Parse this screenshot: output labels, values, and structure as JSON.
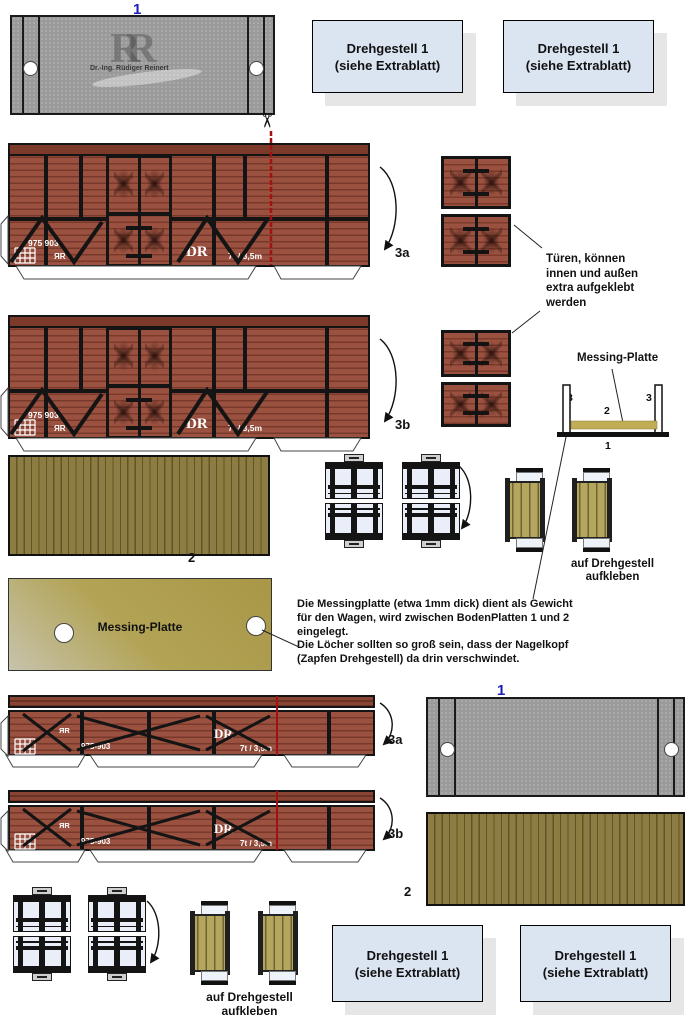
{
  "sheet": {
    "part1_label": "1",
    "part2_label": "2",
    "part3a_label": "3a",
    "part3b_label": "3b",
    "scissors_icon": "✂"
  },
  "drehgestell_box": {
    "line1": "Drehgestell 1",
    "line2": "(siehe Extrablatt)"
  },
  "watermark": {
    "initials": "RR",
    "name": "Dr.-Ing. Rüdiger Reinert"
  },
  "wagon_markings": {
    "number": "975 903",
    "number_dash": "975-903",
    "owner_small": "ЯR",
    "owner_large": "DR",
    "load_spec": "7t / 3,5m"
  },
  "notes": {
    "tueren": "Türen, können\ninnen und außen\nextra aufgeklebt\nwerden",
    "auf_drehgestell": "auf Drehgestell\naufkleben",
    "messing_instruction": "Die Messingplatte (etwa 1mm dick) dient als Gewicht\nfür den Wagen, wird zwischen BodenPlatten 1 und 2\neingelegt.\nDie Löcher sollten so groß sein, dass der Nagelkopf\n(Zapfen Drehgestell) da drin verschwindet."
  },
  "messing_diagram": {
    "label": "Messing-Platte",
    "num_wall_left": "3",
    "num_plate": "2",
    "num_wall_right": "3",
    "num_bottom": "1"
  },
  "messing_plate": {
    "label": "Messing-Platte"
  },
  "colors": {
    "wagon_brown": "#9a5140",
    "plank_shadow": "#78392b",
    "frame_black": "#141414",
    "plate_gray": "#9a9a9a",
    "wood_olive": "#8d7d42",
    "brass": "#b2a355",
    "box_blue": "#dbe5f2",
    "label_blue": "#1d1dbb",
    "cut_red": "#a31111",
    "bogie_bg": "#e9eef8"
  }
}
